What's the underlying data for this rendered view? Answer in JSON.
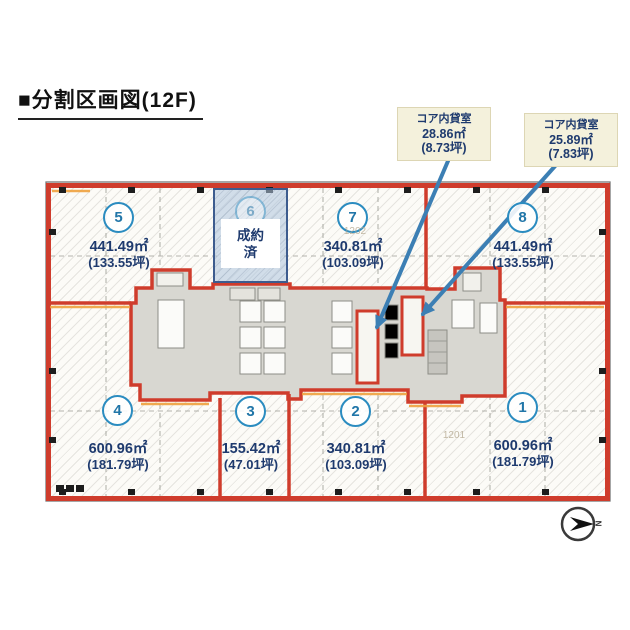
{
  "title": "■分割区画図(12F)",
  "callouts": {
    "c1": {
      "label": "コア内貸室",
      "m2": "28.86㎡",
      "tsubo": "(8.73坪)"
    },
    "c2": {
      "label": "コア内貸室",
      "m2": "25.89㎡",
      "tsubo": "(7.83坪)"
    }
  },
  "sections": {
    "s1": {
      "no": "1",
      "m2": "600.96㎡",
      "tsubo": "(181.79坪)"
    },
    "s2": {
      "no": "2",
      "m2": "340.81㎡",
      "tsubo": "(103.09坪)"
    },
    "s3": {
      "no": "3",
      "m2": "155.42㎡",
      "tsubo": "(47.01坪)"
    },
    "s4": {
      "no": "4",
      "m2": "600.96㎡",
      "tsubo": "(181.79坪)"
    },
    "s5": {
      "no": "5",
      "m2": "441.49㎡",
      "tsubo": "(133.55坪)"
    },
    "s6": {
      "no": "6",
      "status": "成約済"
    },
    "s7": {
      "no": "7",
      "m2": "340.81㎡",
      "tsubo": "(103.09坪)"
    },
    "s8": {
      "no": "8",
      "m2": "441.49㎡",
      "tsubo": "(133.55坪)"
    }
  },
  "dims": {
    "left": "1202",
    "right": "1201"
  },
  "compass": {
    "label": "N"
  },
  "colors": {
    "boundary_red": "#cf3c2c",
    "section_navy": "#1e3a6e",
    "circle_blue": "#2b8cc0",
    "arrow_blue": "#3c7fb4",
    "highlight_orange": "#efa23f",
    "callout_bg": "#f4f1dc",
    "contracted_fill": "#adc5de",
    "contracted_border": "#3d5c8e",
    "core_gray": "#d8d7d1"
  }
}
